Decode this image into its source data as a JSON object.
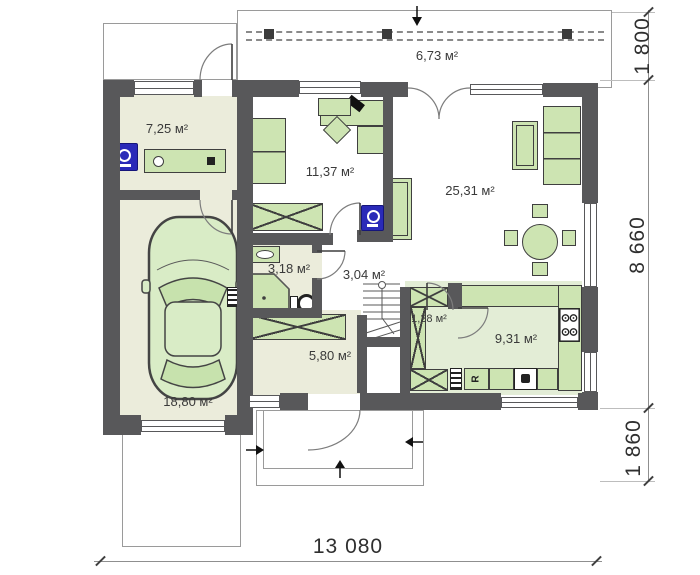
{
  "plan": {
    "rooms": {
      "terrace": "6,73 м²",
      "utility": "7,25 м²",
      "cabinet": "11,37 м²",
      "living": "25,31 м²",
      "bathroom": "3,18 м²",
      "hallway": "3,04 м²",
      "hall": "5,80 м²",
      "pantry": "1,28 м²",
      "kitchen": "9,31 м²",
      "garage": "18,80 м²"
    },
    "dimensions": {
      "terrace_depth": "1 800",
      "house_depth": "8 660",
      "porch_depth": "1 860",
      "total_width": "13 080"
    },
    "labels": {
      "fridge": "R"
    },
    "colors": {
      "wall": "#58585a",
      "floor_beige": "#ebecdb",
      "floor_green": "#e3edd6",
      "furniture": "#cde4b2",
      "appliance_blue": "#2a2ab8",
      "dim_line": "#8f8f8f",
      "text": "#3a3a3a"
    }
  }
}
